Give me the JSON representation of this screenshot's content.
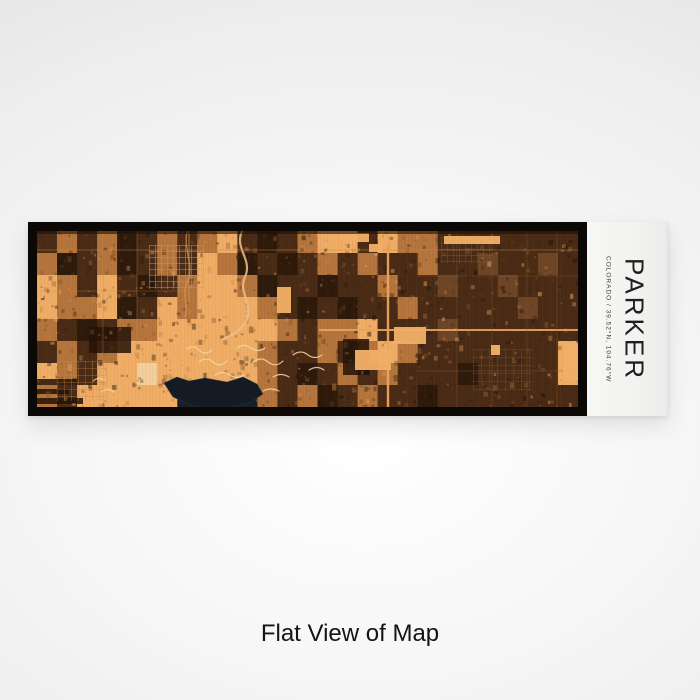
{
  "page": {
    "caption": "Flat View of Map",
    "background_edge_color": "#dfdfdf",
    "background_center_color": "#ffffff"
  },
  "product": {
    "frame_color": "#0b0806",
    "label_panel": {
      "title": "PARKER",
      "subtitle": "COLORADO  /  39.52°N, 104.76°W",
      "bg_color": "#f2f2f0",
      "title_color": "#1f1f1f",
      "subtitle_color": "#3c3c3c"
    },
    "map": {
      "style_name": "ember-satellite-engraving",
      "width": 541,
      "height": 176,
      "cols": 27,
      "rows": 8,
      "base_color": "#e19a55",
      "palette": {
        ".": "#e19a55",
        "o": "#f0ad66",
        "m": "#b5753d",
        "b": "#6e4526",
        "d": "#4a2b15",
        "D": "#2e1a0b",
        "w": "#16202b",
        "p": "#f3cf9b"
      },
      "texture_rows": [
        "dmdmDdmdmodDdmoodommddddddd",
        "mDdmDdmdomDdDdmdmddmddbddbd",
        "omdodDdmoomDddDddmddbddbddd",
        "ommoDdomooomdDdDddmdddddbdd",
        "mdDdmmoooooomdmmodddbdddddd",
        "dmdmooooooomddmdmomdddddddo",
        "omdoopooooomdDdmdmdddDddddo",
        "mdooooowwwwmdmDdmddDddddddd"
      ],
      "seed": 11,
      "noise": {
        "count": 1100,
        "colors": [
          "#2b1708",
          "#5a3820",
          "#f0ad66",
          "#c07f45",
          "#1c0f05",
          "#8a5a30",
          "#3a2412"
        ]
      },
      "grain": {
        "step": 3.5,
        "dark_color": "#1c0e04",
        "dark_opacity": 0.05,
        "light_step": 9,
        "light_color": "#ffd9a0",
        "light_opacity": 0.035
      },
      "dark_rects": [
        [
          0,
          148,
          40,
          6
        ],
        [
          0,
          158,
          32,
          5
        ],
        [
          0,
          167,
          46,
          6
        ],
        [
          52,
          96,
          42,
          26
        ],
        [
          306,
          108,
          26,
          36
        ]
      ],
      "street_grids": [
        {
          "x": 112,
          "y": 14,
          "w": 54,
          "h": 44,
          "step": 6,
          "color": "#d6954f",
          "opacity": 0.8
        },
        {
          "x": 404,
          "y": 6,
          "w": 52,
          "h": 26,
          "step": 6,
          "color": "#8a5a30",
          "opacity": 0.7
        },
        {
          "x": 436,
          "y": 118,
          "w": 60,
          "h": 42,
          "step": 8,
          "color": "#7a4e2a",
          "opacity": 0.7
        },
        {
          "x": 20,
          "y": 130,
          "w": 50,
          "h": 40,
          "step": 7,
          "color": "#c98a4c",
          "opacity": 0.5
        }
      ],
      "paths": [
        {
          "d": "M205,0 C197,18 216,28 208,46 C201,62 216,72 210,88 C206,98 196,104 186,108",
          "c": "#ecc08a",
          "w": 2.2,
          "o": 0.85
        },
        {
          "d": "M150,0 C146,20 158,34 150,52 C144,64 152,74 148,86",
          "c": "#d89a55",
          "w": 1.4,
          "o": 0.7
        },
        {
          "d": "M150,118 q6,-5 12,1 q6,6 13,0",
          "c": "#f5d7a6",
          "w": 1.2,
          "o": 0.85
        },
        {
          "d": "M162,131 q7,-6 14,0 q7,6 14,-1",
          "c": "#f5d7a6",
          "w": 1.2,
          "o": 0.85
        },
        {
          "d": "M178,144 q8,-5 15,0 q7,5 14,0",
          "c": "#f5d7a6",
          "w": 1.2,
          "o": 0.85
        },
        {
          "d": "M200,117 q7,-5 14,0 q7,5 14,0",
          "c": "#f5d7a6",
          "w": 1.2,
          "o": 0.85
        },
        {
          "d": "M216,131 q8,-6 15,0 q8,6 15,-1",
          "c": "#f5d7a6",
          "w": 1.2,
          "o": 0.85
        },
        {
          "d": "M236,146 q8,-5 16,0",
          "c": "#f5d7a6",
          "w": 1.2,
          "o": 0.85
        },
        {
          "d": "M256,124 q8,-6 15,0 q7,5 14,0",
          "c": "#f5d7a6",
          "w": 1.2,
          "o": 0.85
        },
        {
          "d": "M272,139 q8,-5 15,0",
          "c": "#f5d7a6",
          "w": 1.2,
          "o": 0.85
        },
        {
          "d": "M192,157 q9,-5 17,0",
          "c": "#f5d7a6",
          "w": 1.2,
          "o": 0.85
        },
        {
          "d": "M226,160 q8,-4 16,0",
          "c": "#f5d7a6",
          "w": 1.2,
          "o": 0.85
        },
        {
          "d": "M56,150 q6,-5 12,0",
          "c": "#f5d7a6",
          "w": 1.1,
          "o": 0.8
        },
        {
          "d": "M64,161 q7,-5 13,0",
          "c": "#f5d7a6",
          "w": 1.1,
          "o": 0.8
        }
      ],
      "water": {
        "points": "127,152 140,146 152,150 168,147 190,151 206,146 220,153 226,163 214,171 196,176 158,176 136,166",
        "color": "#141b24"
      },
      "roads": [
        {
          "x1": 351,
          "y1": 0,
          "x2": 351,
          "y2": 176,
          "w": 2.4,
          "c": "#eda45c",
          "o": 0.95
        },
        {
          "x1": 282,
          "y1": 99,
          "x2": 541,
          "y2": 99,
          "w": 2,
          "c": "#eda45c",
          "o": 0.9
        },
        {
          "x1": 0,
          "y1": 19,
          "x2": 541,
          "y2": 19,
          "w": 1,
          "c": "#c8884a",
          "o": 0.45
        },
        {
          "x1": 152,
          "y1": 0,
          "x2": 152,
          "y2": 70,
          "w": 1.2,
          "c": "#d89a55",
          "o": 0.6
        },
        {
          "x1": 420,
          "y1": 0,
          "x2": 420,
          "y2": 176,
          "w": 0.7,
          "c": "#8a5a30",
          "o": 0.55
        },
        {
          "x1": 455,
          "y1": 0,
          "x2": 455,
          "y2": 176,
          "w": 0.7,
          "c": "#8a5a30",
          "o": 0.55
        },
        {
          "x1": 490,
          "y1": 0,
          "x2": 490,
          "y2": 176,
          "w": 0.7,
          "c": "#8a5a30",
          "o": 0.55
        },
        {
          "x1": 520,
          "y1": 0,
          "x2": 520,
          "y2": 176,
          "w": 0.7,
          "c": "#8a5a30",
          "o": 0.55
        },
        {
          "x1": 380,
          "y1": 45,
          "x2": 541,
          "y2": 45,
          "w": 0.7,
          "c": "#8a5a30",
          "o": 0.5
        },
        {
          "x1": 380,
          "y1": 140,
          "x2": 541,
          "y2": 140,
          "w": 0.7,
          "c": "#8a5a30",
          "o": 0.5
        },
        {
          "x1": 66,
          "y1": 0,
          "x2": 66,
          "y2": 176,
          "w": 0.8,
          "c": "#c8884a",
          "o": 0.4
        },
        {
          "x1": 100,
          "y1": 0,
          "x2": 100,
          "y2": 120,
          "w": 0.8,
          "c": "#c8884a",
          "o": 0.4
        },
        {
          "x1": 0,
          "y1": 60,
          "x2": 150,
          "y2": 60,
          "w": 0.8,
          "c": "#c8884a",
          "o": 0.4
        }
      ],
      "bright_rects": [
        [
          407,
          5,
          56,
          8
        ],
        [
          526,
          112,
          15,
          38
        ],
        [
          454,
          114,
          9,
          10
        ],
        [
          357,
          96,
          32,
          17
        ],
        [
          318,
          119,
          36,
          20
        ],
        [
          302,
          2,
          30,
          9
        ],
        [
          332,
          13,
          13,
          8
        ],
        [
          240,
          56,
          14,
          26
        ]
      ],
      "top_shade": {
        "rect": [
          0,
          0,
          541,
          3
        ],
        "color": "#1a0f06",
        "opacity": 0.6
      }
    }
  }
}
